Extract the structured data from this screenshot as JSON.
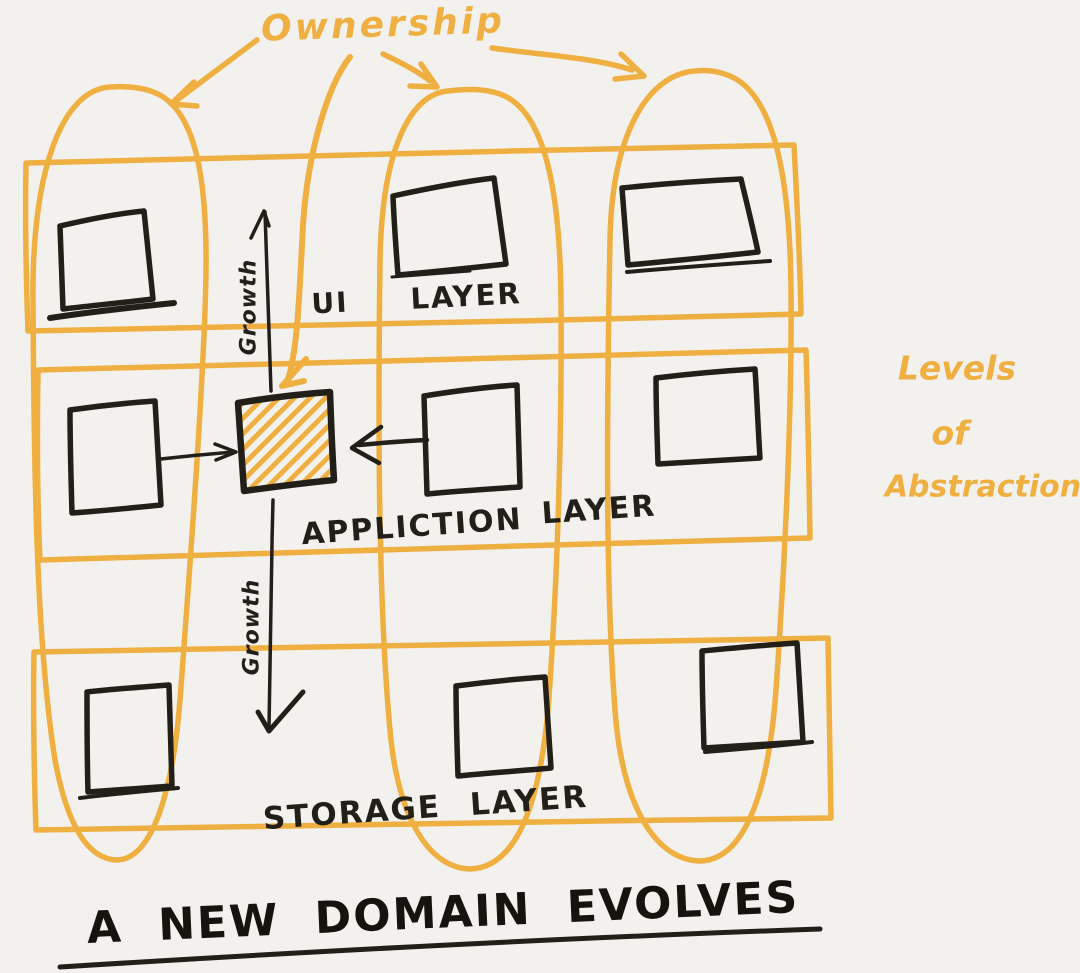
{
  "colors": {
    "yellow": "#EFB041",
    "black": "#221F18",
    "paper": "#F2F1EE"
  },
  "top": {
    "ownership_label": "Ownership"
  },
  "grid": {
    "layers": [
      {
        "word": "UI",
        "suffix": "LAYER"
      },
      {
        "word": "APPLICTION",
        "suffix": "LAYER"
      },
      {
        "word": "STORAGE",
        "suffix": "LAYER"
      }
    ],
    "growth_top": "Growth",
    "growth_bottom": "Growth",
    "ownership_columns": 3,
    "squares_per_layer": 3,
    "highlighted_square": "application-layer-center"
  },
  "right_note": {
    "line1": "Levels",
    "line2": "of",
    "line3": "Abstraction"
  },
  "footer": {
    "title": "A NEW DOMAIN EVOLVES"
  }
}
